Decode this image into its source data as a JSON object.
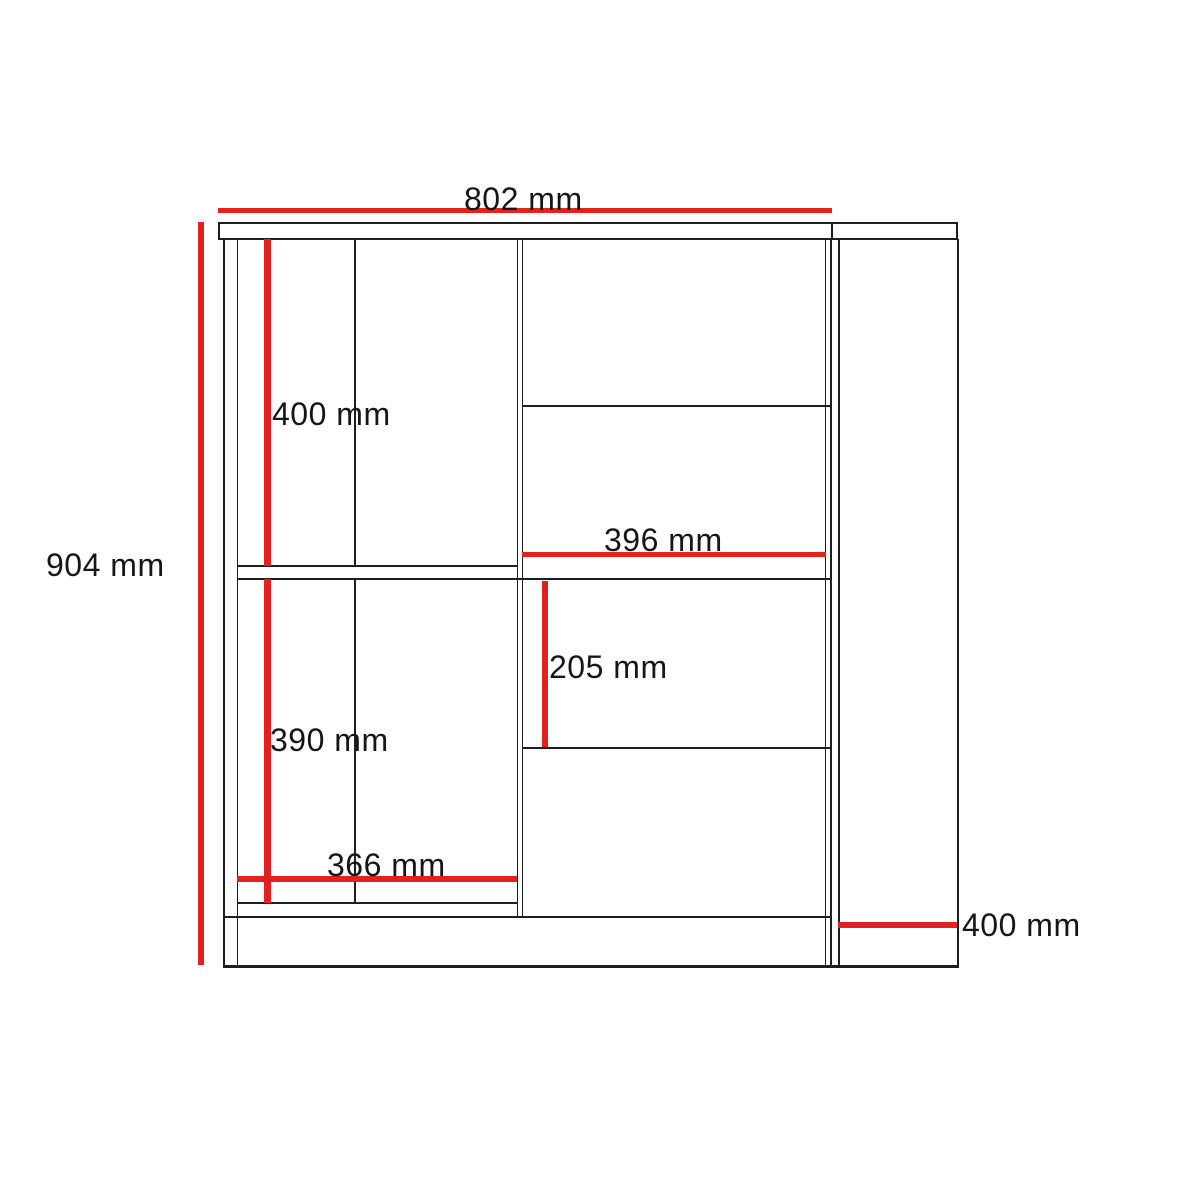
{
  "diagram": {
    "kind": "furniture-dimension-drawing",
    "unit": "mm",
    "colors": {
      "outline": "#1e1e1e",
      "dimension": "#e3211f",
      "background": "#ffffff"
    },
    "dimensions": [
      {
        "name": "overall-width",
        "label": "802 mm",
        "value": 802
      },
      {
        "name": "overall-height",
        "label": "904 mm",
        "value": 904
      },
      {
        "name": "upper-left-compartment-height",
        "label": "400 mm",
        "value": 400
      },
      {
        "name": "drawer-width",
        "label": "396 mm",
        "value": 396
      },
      {
        "name": "middle-drawer-height",
        "label": "205 mm",
        "value": 205
      },
      {
        "name": "lower-left-compartment-height",
        "label": "390 mm",
        "value": 390
      },
      {
        "name": "left-compartment-width",
        "label": "366 mm",
        "value": 366
      },
      {
        "name": "side-panel-depth",
        "label": "400 mm",
        "value": 400
      }
    ]
  }
}
